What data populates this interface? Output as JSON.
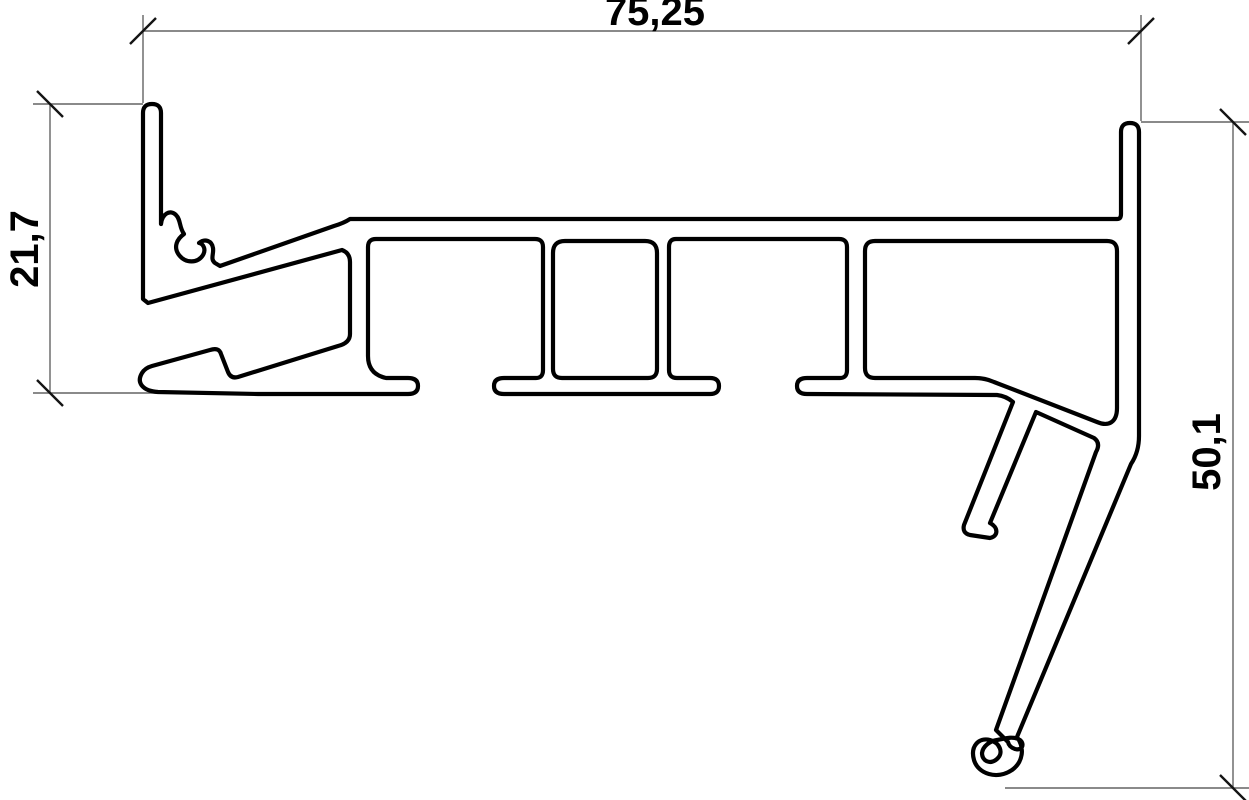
{
  "drawing": {
    "type": "technical-profile-cross-section",
    "description": "CAD line drawing of an extruded frame profile with three linear dimensions",
    "dimensions": {
      "width_top": "75,25",
      "height_left": "21,7",
      "height_right": "50,1"
    },
    "colors": {
      "background": "#ffffff",
      "profile_line": "#000000",
      "dimension_line": "#646464",
      "tick_mark": "#141414",
      "text": "#000000"
    }
  }
}
